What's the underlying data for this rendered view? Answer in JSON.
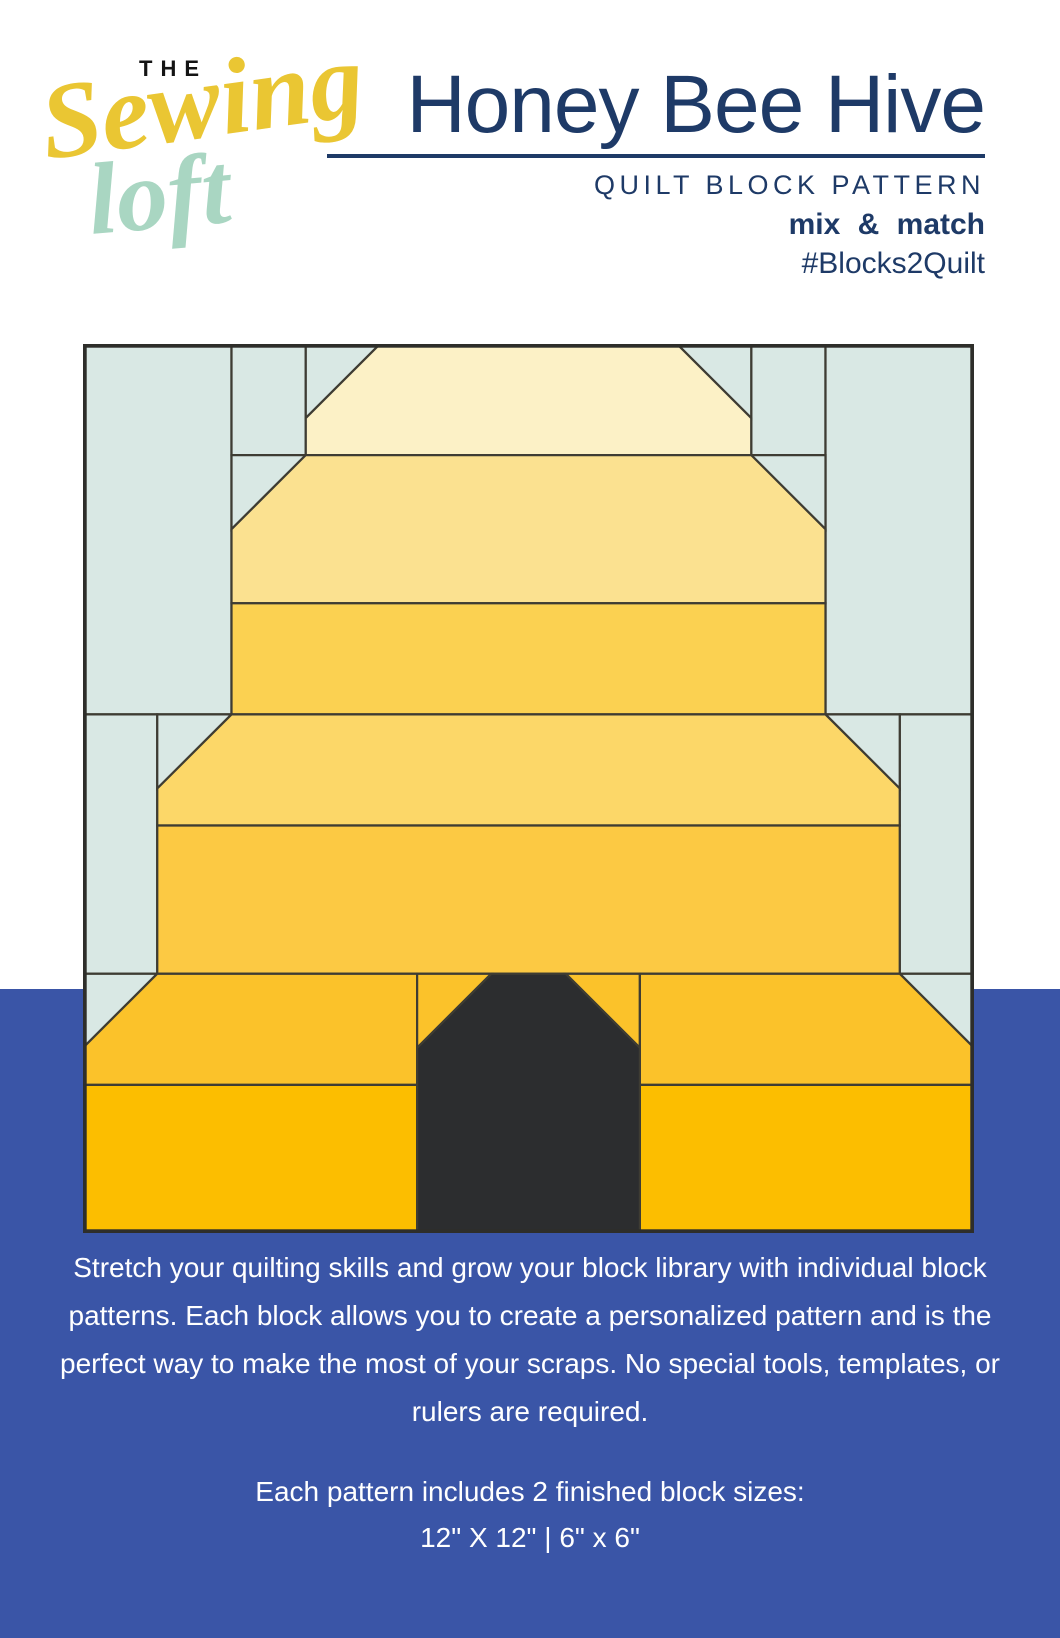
{
  "header": {
    "logo": {
      "the": "THE",
      "sewing": "Sewing",
      "loft": "loft",
      "colors": {
        "the": "#141414",
        "sewing": "#EAC633",
        "loft": "#A9D6C2"
      }
    },
    "title": "Honey Bee Hive",
    "subtitle": "QUILT BLOCK PATTERN",
    "tagline": "mix & match",
    "hashtag": "#Blocks2Quilt",
    "accent_navy": "#1E3A67"
  },
  "quilt_block": {
    "description": "Honey Bee Hive patchwork quilt block: yellow beehive skep with dark doorway on light blue background, pieced on a 12x12 grid",
    "grid": 12,
    "palette": {
      "bg": "#D9E8E4",
      "band1": "#FCF1C6",
      "band2": "#FBE190",
      "band3": "#FBD151",
      "band4": "#FCD768",
      "band5": "#FCC943",
      "band6": "#FBC22A",
      "band7": "#FCBE00",
      "door": "#2C2D2F",
      "seam": "#3E3C33"
    },
    "pieces": [
      {
        "name": "bg-rect-top-left",
        "fill": "bg",
        "points": "0,0 2,0 2,5 0,5"
      },
      {
        "name": "bg-rect-a",
        "fill": "bg",
        "points": "2,0 3,0 3,1.5 2,1.5"
      },
      {
        "name": "bg-tri-a",
        "fill": "bg",
        "points": "3,0 4,0 3,1"
      },
      {
        "name": "bg-tri-b",
        "fill": "bg",
        "points": "2,1.5 3,1.5 2,2.5"
      },
      {
        "name": "bg-rect-b",
        "fill": "bg",
        "points": "9,0 10,0 10,1.5 9,1.5"
      },
      {
        "name": "bg-rect-top-right",
        "fill": "bg",
        "points": "10,0 12,0 12,5 10,5"
      },
      {
        "name": "bg-tri-c",
        "fill": "bg",
        "points": "8,0 9,0 9,1"
      },
      {
        "name": "bg-tri-d",
        "fill": "bg",
        "points": "9,1.5 10,1.5 10,2.5"
      },
      {
        "name": "bg-rect-mid-left",
        "fill": "bg",
        "points": "0,5 1,5 1,8.5 0,8.5"
      },
      {
        "name": "bg-tri-e",
        "fill": "bg",
        "points": "1,5 2,5 1,6"
      },
      {
        "name": "bg-rect-mid-right",
        "fill": "bg",
        "points": "11,5 12,5 12,8.5 11,8.5"
      },
      {
        "name": "bg-tri-f",
        "fill": "bg",
        "points": "10,5 11,5 11,6"
      },
      {
        "name": "bg-tri-bottom-left",
        "fill": "bg",
        "points": "0,8.5 1,8.5 0,9.5"
      },
      {
        "name": "bg-tri-bottom-right",
        "fill": "bg",
        "points": "11,8.5 12,8.5 12,9.5"
      },
      {
        "name": "hive-band1-cap",
        "fill": "band1",
        "points": "4,0 8,0 9,1 9,1.5 3,1.5 3,1"
      },
      {
        "name": "hive-band2",
        "fill": "band2",
        "points": "3,1.5 9,1.5 10,2.5 10,3.5 2,3.5 2,2.5"
      },
      {
        "name": "hive-band3",
        "fill": "band3",
        "points": "2,3.5 10,3.5 10,5 2,5"
      },
      {
        "name": "hive-band4",
        "fill": "band4",
        "points": "2,5 10,5 11,6 11,6.5 1,6.5 1,6"
      },
      {
        "name": "hive-band5",
        "fill": "band5",
        "points": "1,6.5 11,6.5 11,8.5 1,8.5"
      },
      {
        "name": "hive-band6-left",
        "fill": "band6",
        "points": "1,8.5 4.5,8.5 4.5,10 0,10 0,9.5"
      },
      {
        "name": "hive-band6-door-tri-l",
        "fill": "band6",
        "points": "4.5,8.5 5.5,8.5 4.5,9.5"
      },
      {
        "name": "hive-band6-door-tri-r",
        "fill": "band6",
        "points": "6.5,8.5 7.5,8.5 7.5,9.5"
      },
      {
        "name": "hive-band6-right",
        "fill": "band6",
        "points": "7.5,8.5 11,8.5 12,9.5 12,10 7.5,10"
      },
      {
        "name": "hive-band7-left",
        "fill": "band7",
        "points": "0,10 4.5,10 4.5,12 0,12"
      },
      {
        "name": "hive-band7-right",
        "fill": "band7",
        "points": "7.5,10 12,10 12,12 7.5,12"
      },
      {
        "name": "hive-doorway",
        "fill": "door",
        "points": "5.5,8.5 6.5,8.5 7.5,9.5 7.5,12 4.5,12 4.5,9.5"
      }
    ]
  },
  "footer": {
    "background": "#3A55A7",
    "paragraph": "Stretch your quilting skills and grow your block library with individual block patterns. Each block allows you to create a personalized pattern and is the perfect way to make the most of your scraps. No special tools, templates, or rulers are required.",
    "sizes_heading": "Each pattern includes 2 finished block sizes:",
    "sizes_value": "12\" X 12\" | 6\" x 6\""
  }
}
